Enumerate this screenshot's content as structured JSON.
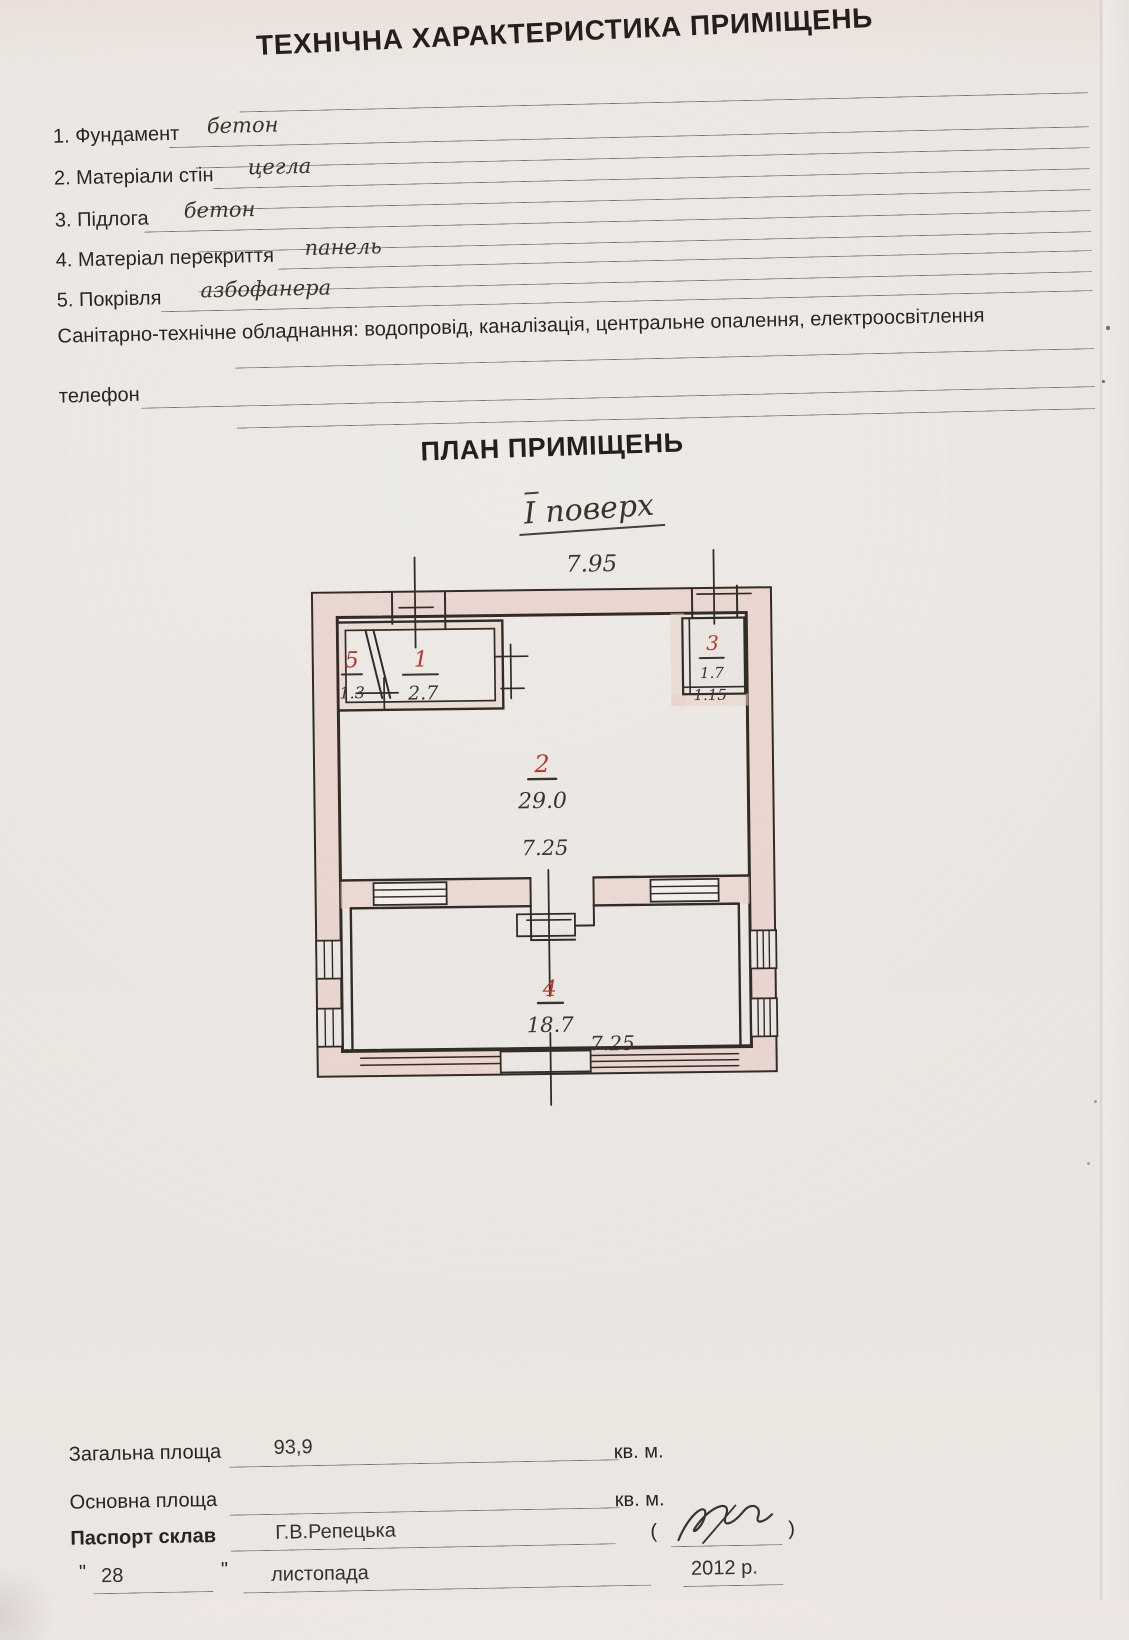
{
  "document": {
    "title": "ТЕХНІЧНА ХАРАКТЕРИСТИКА ПРИМІЩЕНЬ",
    "items": [
      {
        "label": "1. Фундамент",
        "value": "бетон"
      },
      {
        "label": "2. Матеріали стін",
        "value": "цегла"
      },
      {
        "label": "3. Підлога",
        "value": "бетон"
      },
      {
        "label": "4. Матеріал перекриття",
        "value": "панель"
      },
      {
        "label": "5. Покрівля",
        "value": "азбофанера"
      }
    ],
    "sanitary_line": "Санітарно-технічне обладнання: водопровід, каналізація, центральне опалення, електроосвітлення",
    "phone_label": "телефон"
  },
  "plan": {
    "heading": "ПЛАН ПРИМІЩЕНЬ",
    "floor_label": "І поверх",
    "top_dimension": "7.95",
    "rooms": [
      {
        "number": "5",
        "area": "1.3"
      },
      {
        "number": "1",
        "area": "2.7"
      },
      {
        "number": "3",
        "area": "1.7",
        "dimension": "1.15"
      },
      {
        "number": "2",
        "area": "29.0",
        "dimension": "7.25"
      },
      {
        "number": "4",
        "area": "18.7",
        "dimension": "7.25"
      }
    ],
    "colors": {
      "room_number_ink": "#b5372a",
      "wall_fill": "#e9cfc8",
      "line_ink": "#332c26"
    }
  },
  "footer": {
    "total_area_label": "Загальна площа",
    "total_area_value": "93,9",
    "area_unit": "кв. м.",
    "main_area_label": "Основна площа",
    "main_area_unit": "кв. м.",
    "passport_label": "Паспорт склав",
    "passport_value": "Г.В.Репецька",
    "paren_open": "(",
    "paren_close": ")",
    "quote_open": "\"",
    "quote_close": "\"",
    "day": "28",
    "month": "листопада",
    "year": "2012 р."
  }
}
